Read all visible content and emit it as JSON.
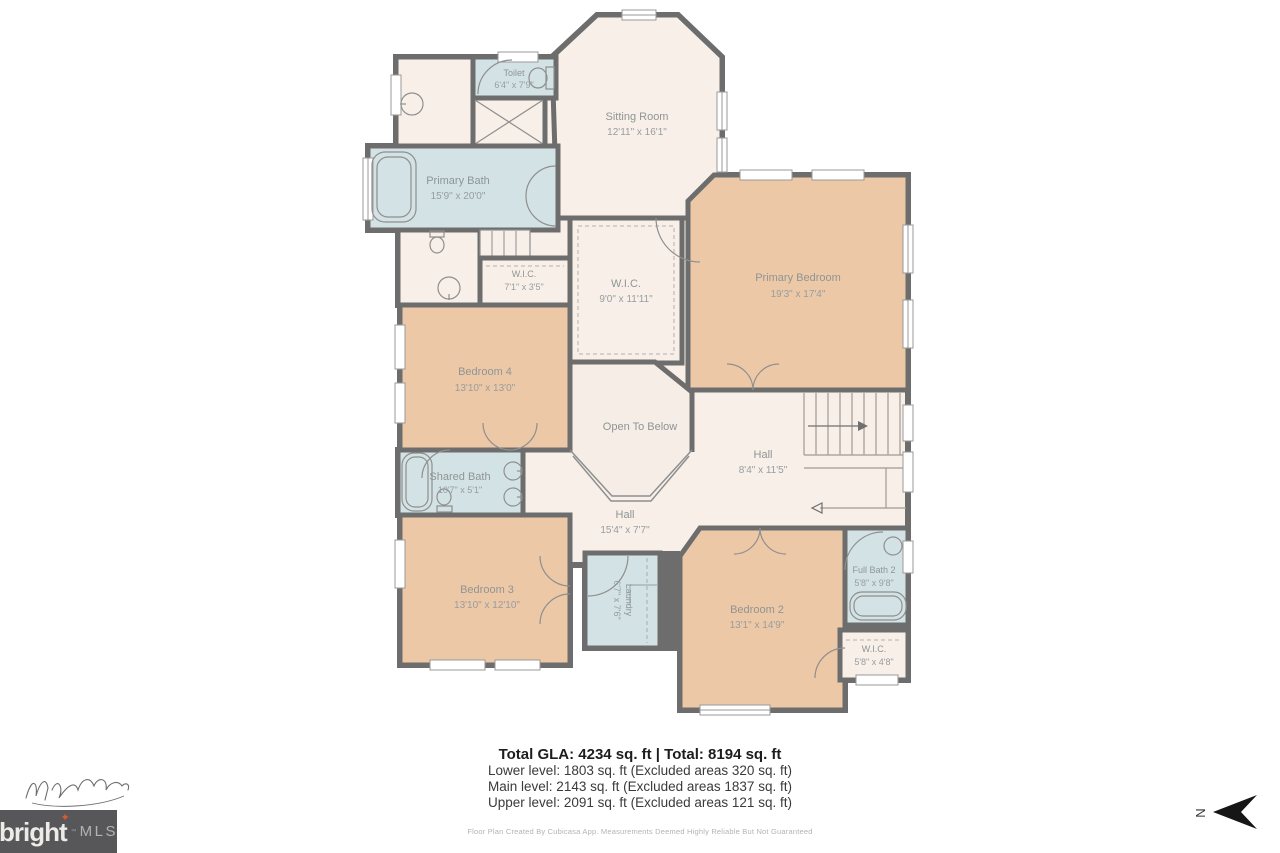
{
  "rooms": {
    "toilet": {
      "name": "Toilet",
      "dims": "6'4\" x 7'9\""
    },
    "sitting_room": {
      "name": "Sitting Room",
      "dims": "12'11\" x 16'1\""
    },
    "primary_bath": {
      "name": "Primary Bath",
      "dims": "15'9\" x 20'0\""
    },
    "wic_small": {
      "name": "W.I.C.",
      "dims": "7'1\" x 3'5\""
    },
    "wic_primary": {
      "name": "W.I.C.",
      "dims": "9'0\" x 11'11\""
    },
    "primary_bedroom": {
      "name": "Primary Bedroom",
      "dims": "19'3\" x 17'4\""
    },
    "bedroom4": {
      "name": "Bedroom 4",
      "dims": "13'10\" x 13'0\""
    },
    "open_to_below": {
      "name": "Open To Below"
    },
    "hall_upper": {
      "name": "Hall",
      "dims": "8'4\" x 11'5\""
    },
    "shared_bath": {
      "name": "Shared Bath",
      "dims": "10'7\" x 5'1\""
    },
    "hall_lower": {
      "name": "Hall",
      "dims": "15'4\" x 7'7\""
    },
    "bedroom3": {
      "name": "Bedroom 3",
      "dims": "13'10\" x 12'10\""
    },
    "laundry": {
      "name": "Laundry",
      "dims": "6'7\" x 7'6\""
    },
    "bedroom2": {
      "name": "Bedroom 2",
      "dims": "13'1\" x 14'9\""
    },
    "full_bath2": {
      "name": "Full Bath 2",
      "dims": "5'8\" x 9'8\""
    },
    "wic2": {
      "name": "W.I.C.",
      "dims": "5'8\" x 4'8\""
    }
  },
  "summary": {
    "total": "Total GLA: 4234 sq. ft | Total: 8194 sq. ft",
    "lower": "Lower level: 1803 sq. ft (Excluded areas 320 sq. ft)",
    "main": "Main level: 2143 sq. ft (Excluded areas 1837 sq. ft)",
    "upper": "Upper level: 2091 sq. ft (Excluded areas 121 sq. ft)",
    "disclaimer": "Floor Plan Created By Cubicasa App. Measurements Deemed Highly Reliable But Not Guaranteed"
  },
  "branding": {
    "name": "bright",
    "mls": "MLS",
    "tm": "™",
    "star_glyph": "✦"
  },
  "compass": {
    "north": "N"
  },
  "colors": {
    "wall": "#6d6d6d",
    "bedroom_fill": "#ecc8a6",
    "bath_fill": "#d3e2e4",
    "hall_fill": "#f7efe8",
    "logo_bg": "#57575a",
    "logo_star": "#de5a2c"
  }
}
